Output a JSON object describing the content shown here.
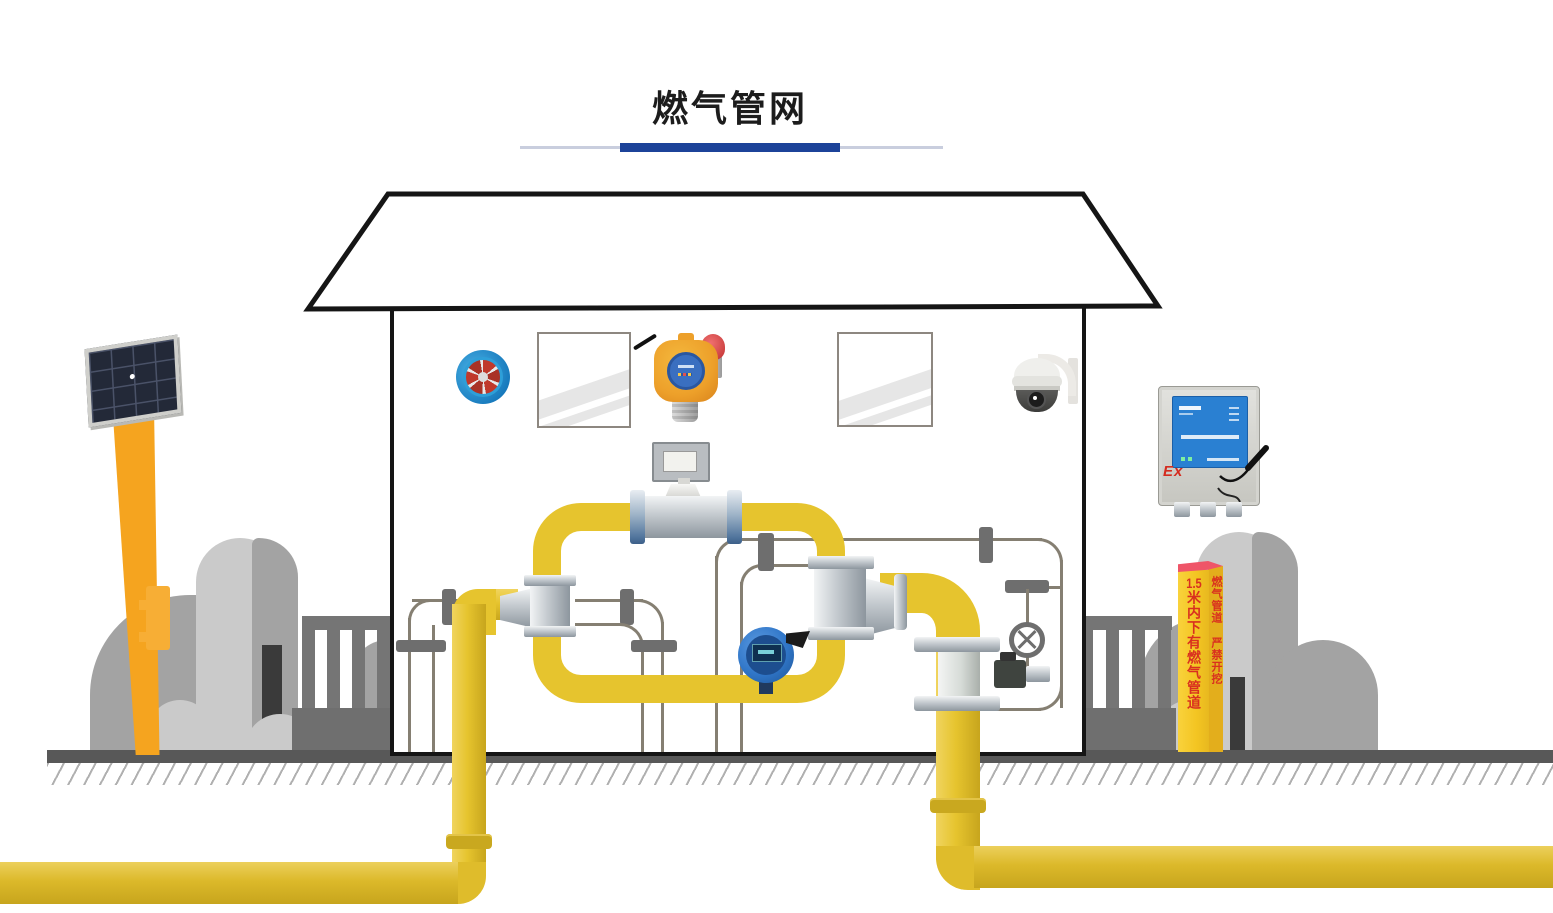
{
  "header": {
    "title": "燃气管网",
    "underline": {
      "line_color": "#c9cede",
      "accent_color": "#1c4399"
    }
  },
  "marker_post": {
    "front_text_number": "1.5",
    "front_text": "米内下有燃气管道",
    "side_text": "燃气管道 严禁开挖",
    "body_color": "#f3c522",
    "cap_color": "#ef5568",
    "text_color": "#d9301f"
  },
  "control_box": {
    "ex_label": "Ex",
    "panel_color": "#2a80d2",
    "body_color": "#d9d9d4"
  },
  "colors": {
    "pipe_yellow": "#e6c42e",
    "pipe_underground": "#dfbc2b",
    "steel": "#c3c9ce",
    "thin_pipe": "#857f72",
    "ground": "#585858",
    "bush_light": "#cacaca",
    "bush_medium": "#a3a3a3",
    "fence": "#757575",
    "tree_trunk": "#3a3a3a",
    "pole_orange": "#f5a41f",
    "solar_cell": "#232938",
    "detector_orange": "#eda02a",
    "transmitter_blue": "#3076c8",
    "camera_white": "#efefec",
    "house_outline": "#151515"
  },
  "icons": [
    {
      "name": "solar-panel-icon"
    },
    {
      "name": "exhaust-fan-icon"
    },
    {
      "name": "gas-detector-icon"
    },
    {
      "name": "flow-meter-icon"
    },
    {
      "name": "ptz-camera-icon"
    },
    {
      "name": "pressure-transmitter-icon"
    },
    {
      "name": "flanged-valve-icon"
    },
    {
      "name": "handwheel-valve-icon"
    },
    {
      "name": "rtu-control-box-icon"
    },
    {
      "name": "warning-post-icon"
    }
  ]
}
